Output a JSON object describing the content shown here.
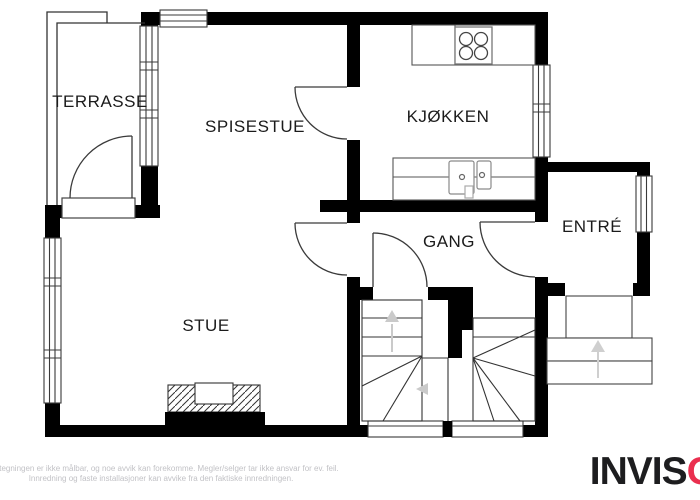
{
  "plan": {
    "rooms": [
      {
        "id": "terrasse",
        "label": "TERRASSE"
      },
      {
        "id": "spisestue",
        "label": "SPISESTUE"
      },
      {
        "id": "kjokken",
        "label": "KJØKKEN"
      },
      {
        "id": "gang",
        "label": "GANG"
      },
      {
        "id": "entre",
        "label": "ENTRÉ"
      },
      {
        "id": "stue",
        "label": "STUE"
      }
    ],
    "fixture_icons": [
      "stove-icon",
      "sink-icon",
      "fireplace-icon",
      "stairs-up-arrow-icon",
      "entry-up-arrow-icon"
    ]
  },
  "footer": {
    "disclaimer_line1": "Plantegningen er ikke målbar, og noe avvik kan forekomme. Megler/selger tar ikke ansvar for ev. feil.",
    "disclaimer_line2": "Innredning og faste installasjoner kan avvike fra den faktiske innredningen."
  },
  "branding": {
    "logo_black": "INVIS",
    "logo_red_letter": "O",
    "logo_red_color": "#ea2f4f"
  }
}
